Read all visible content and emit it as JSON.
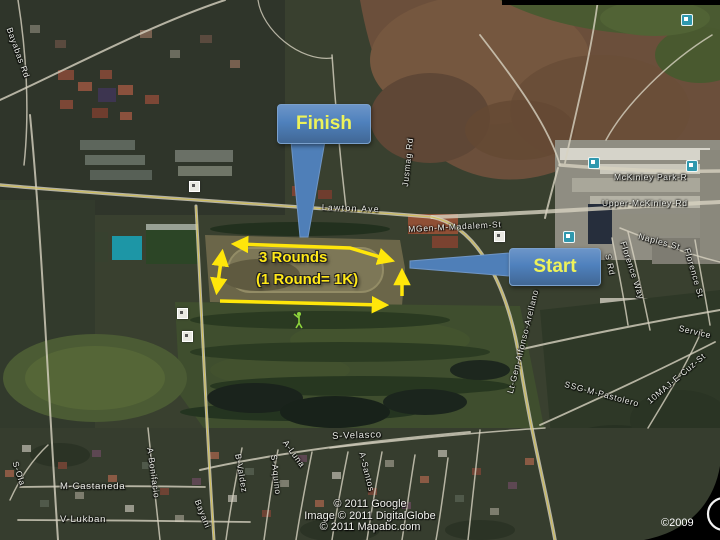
{
  "annotations": {
    "finish_label": "Finish",
    "start_label": "Start",
    "route_note_line1": "3 Rounds",
    "route_note_line2": "(1 Round= 1K)"
  },
  "map": {
    "street_labels": [
      {
        "text": "Bayabas Rd"
      },
      {
        "text": "Lawton Ave"
      },
      {
        "text": "Jusmag Rd"
      },
      {
        "text": "MGen-M-Madalem-St"
      },
      {
        "text": "McKinley Park-R"
      },
      {
        "text": "Upper-McKinley-Rd"
      },
      {
        "text": "Naples St"
      },
      {
        "text": "Florence Way"
      },
      {
        "text": "S Rd"
      },
      {
        "text": "Florence St"
      },
      {
        "text": "Service"
      },
      {
        "text": "Lt-Gen-Alfonso-Arellano"
      },
      {
        "text": "SSG-M-Pastolero"
      },
      {
        "text": "10MAJ-E-Cuz-St"
      },
      {
        "text": "S-Ola"
      },
      {
        "text": "M-Castaneda"
      },
      {
        "text": "V-Lukban"
      },
      {
        "text": "A-Bonifacio"
      },
      {
        "text": "Bayani"
      },
      {
        "text": "B-Valdez"
      },
      {
        "text": "S-Aquino"
      },
      {
        "text": "A-Luna"
      },
      {
        "text": "S-Velasco"
      },
      {
        "text": "A-Santos"
      }
    ],
    "copyright": {
      "line1": "© 2011 Google",
      "line2": "Image © 2011 DigitalGlobe",
      "line3": "© 2011 Mapabc.com",
      "corner_year": "©2009"
    },
    "icons": [
      "bus-stop-icon",
      "poi-box-icon",
      "golfer-icon"
    ]
  },
  "colors": {
    "callout_fill": "#4f81bd",
    "callout_text": "#edf25a",
    "route_yellow": "#ffe60a",
    "label_text": "#eceee8"
  }
}
